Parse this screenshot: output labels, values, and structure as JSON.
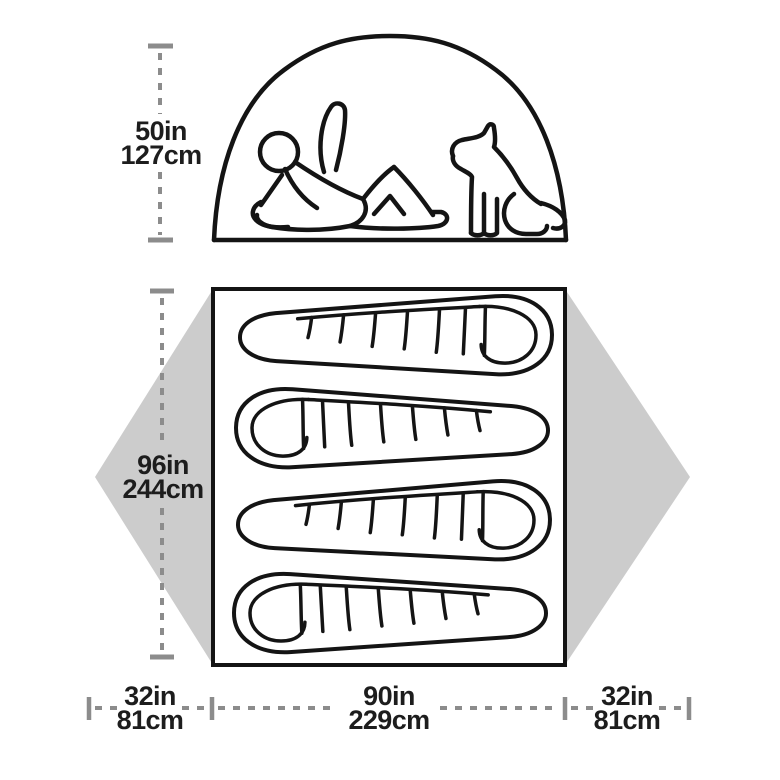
{
  "diagram": {
    "title": "Tent dimensions diagram",
    "colors": {
      "outline": "#141414",
      "vestibule_fill": "#cccccc",
      "dimension_line": "#8c8c8c",
      "label_text": "#1d1d1d",
      "background": "#ffffff"
    },
    "labels": {
      "peak_height": {
        "in": "50in",
        "cm": "127cm"
      },
      "floor_length": {
        "in": "96in",
        "cm": "244cm"
      },
      "floor_width": {
        "in": "90in",
        "cm": "229cm"
      },
      "vestibule_left": {
        "in": "32in",
        "cm": "81cm"
      },
      "vestibule_right": {
        "in": "32in",
        "cm": "81cm"
      }
    }
  }
}
